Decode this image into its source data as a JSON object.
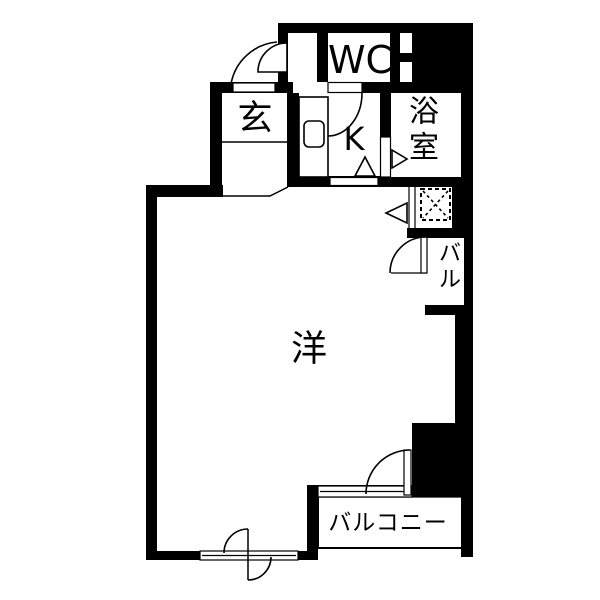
{
  "page": {
    "background": "#ffffff"
  },
  "palette": {
    "wall": "#000000",
    "floor": "#ffffff",
    "line": "#000000"
  },
  "rooms": {
    "wc": {
      "label": "WC"
    },
    "entrance": {
      "label": "玄"
    },
    "kitchen": {
      "label": "K"
    },
    "bath": {
      "line1": "浴",
      "line2": "室"
    },
    "western_room": {
      "label": "洋"
    },
    "side_balcony": {
      "line1": "バ",
      "line2": "ル"
    },
    "balcony": {
      "label": "バルコニー"
    }
  },
  "symbols": {
    "washer_pan": "dashed-square-with-x",
    "kitchen_sink": "rounded-square",
    "door": "quarter-arc-swing",
    "window": "double-line-strip"
  }
}
